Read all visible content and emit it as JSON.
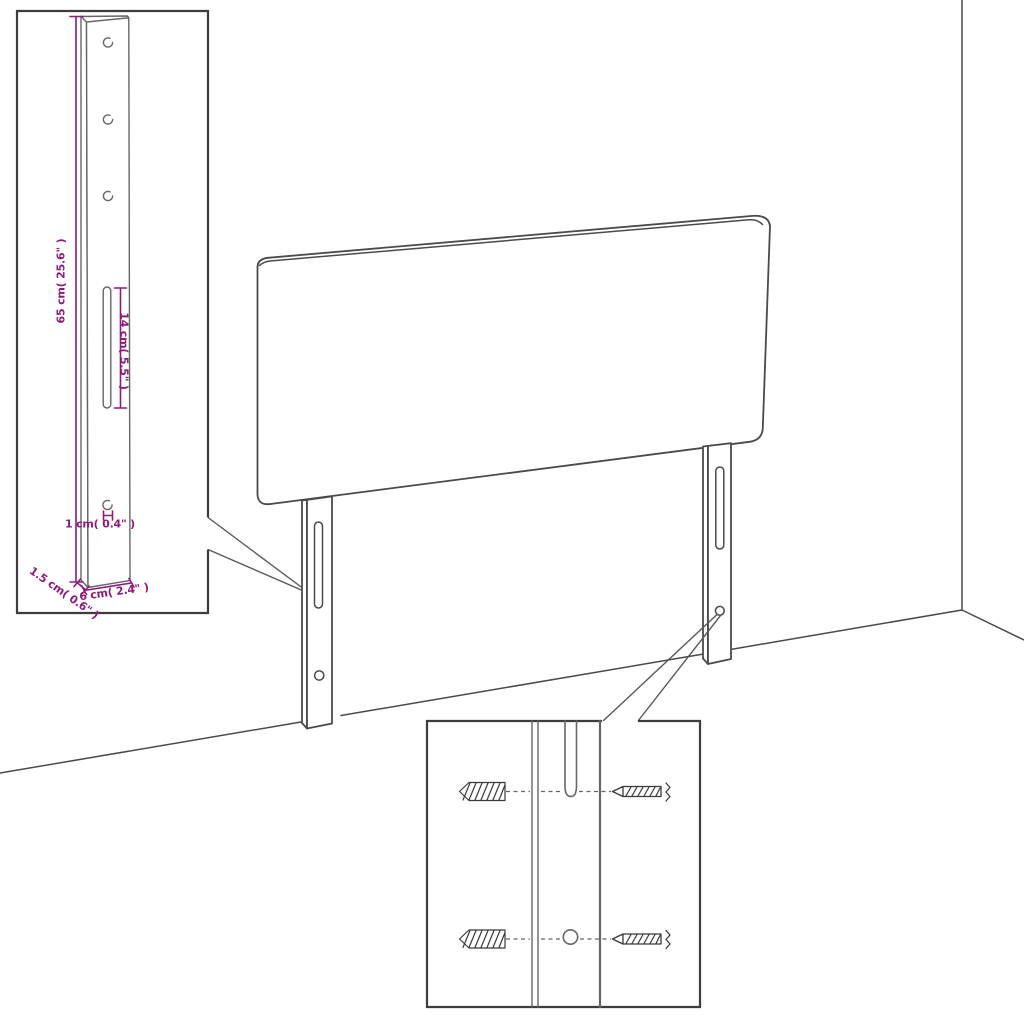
{
  "colors": {
    "background": "#ffffff",
    "drawing_line": "#4a4a4a",
    "detail_line": "#666666",
    "inset_border": "#3d3d3d",
    "dimension": "#8e1b7c"
  },
  "bracket_inset": {
    "height_label": "65 cm( 25.6\" )",
    "slot_label": "14 cm( 5.5\" )",
    "hole_label": "1 cm( 0.4\" )",
    "thickness_label": "1.5 cm( 0.6\" )",
    "width_label": "6 cm( 2.4\" )"
  }
}
